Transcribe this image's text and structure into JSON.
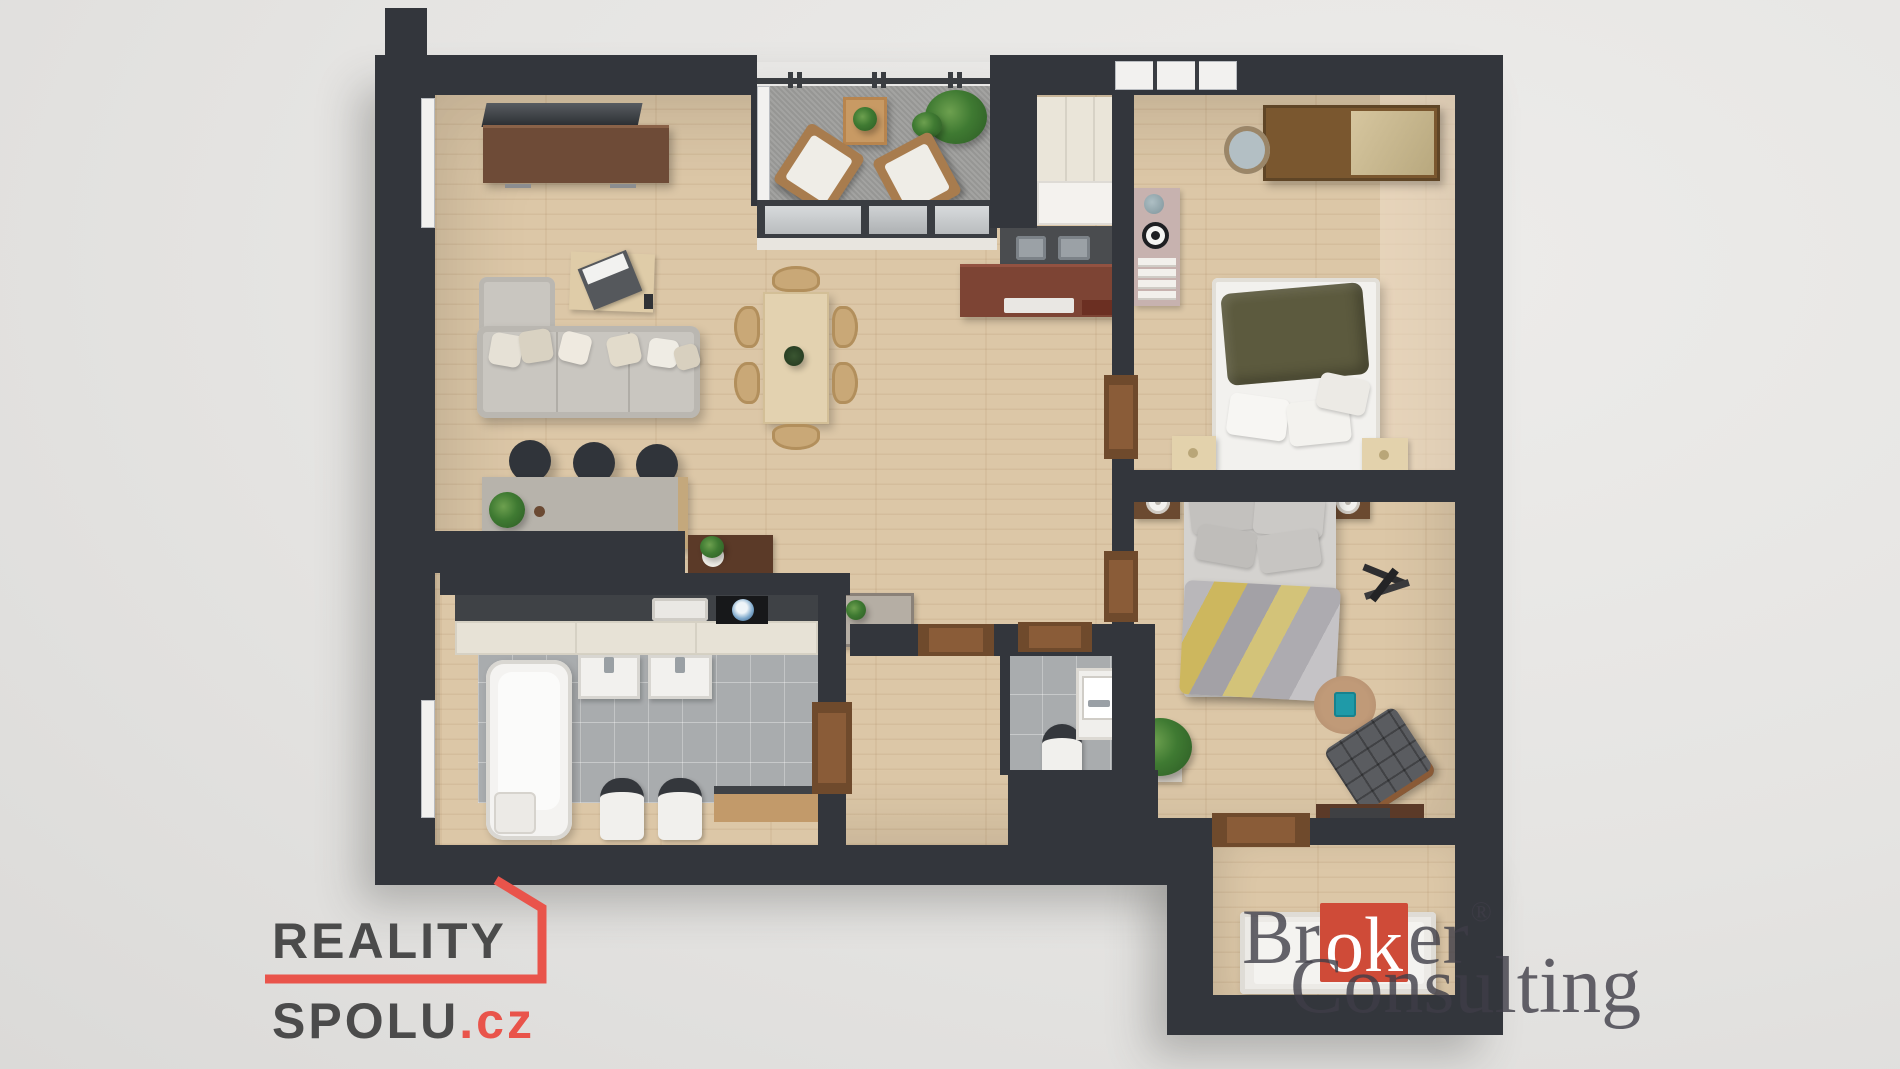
{
  "scene": {
    "type": "3d-floor-plan-render-top-view",
    "background_color": "#e5e4e2"
  },
  "watermarks": {
    "reality_spolu": {
      "line1": "REALITY",
      "line2": "SPOLU",
      "tld": ".cz",
      "text_color": "#4b4b4b",
      "accent_color": "#e9544b"
    },
    "broker_consulting": {
      "prefix": "Br",
      "highlight": "ok",
      "suffix": "er",
      "registered": "®",
      "line2": "Consulting",
      "text_color": "#3e3d47",
      "accent_color": "#cf4b38"
    }
  },
  "palette": {
    "wall": "#33363c",
    "wood_floor": "#dcc7a7",
    "tile_floor": "#a9acae",
    "balcony_floor": "#9e9e9c",
    "counter_dark": "#46484a",
    "cabinet_cream": "#e7e2d6",
    "sideboard_walnut": "#6e4b37",
    "kitchen_mahogany": "#7d4434",
    "sofa_gray": "#c9c6c0",
    "blanket_olive": "#5c5a3e",
    "blanket_yellow": "#cdb75e",
    "pouf_teal": "#1f9aa8"
  },
  "rooms": [
    {
      "name": "living-room"
    },
    {
      "name": "dining-area"
    },
    {
      "name": "kitchen"
    },
    {
      "name": "balcony"
    },
    {
      "name": "bedroom-1"
    },
    {
      "name": "bedroom-2"
    },
    {
      "name": "bathroom"
    },
    {
      "name": "wc"
    },
    {
      "name": "hallway"
    },
    {
      "name": "entry-vestibule"
    },
    {
      "name": "study-nook"
    }
  ]
}
